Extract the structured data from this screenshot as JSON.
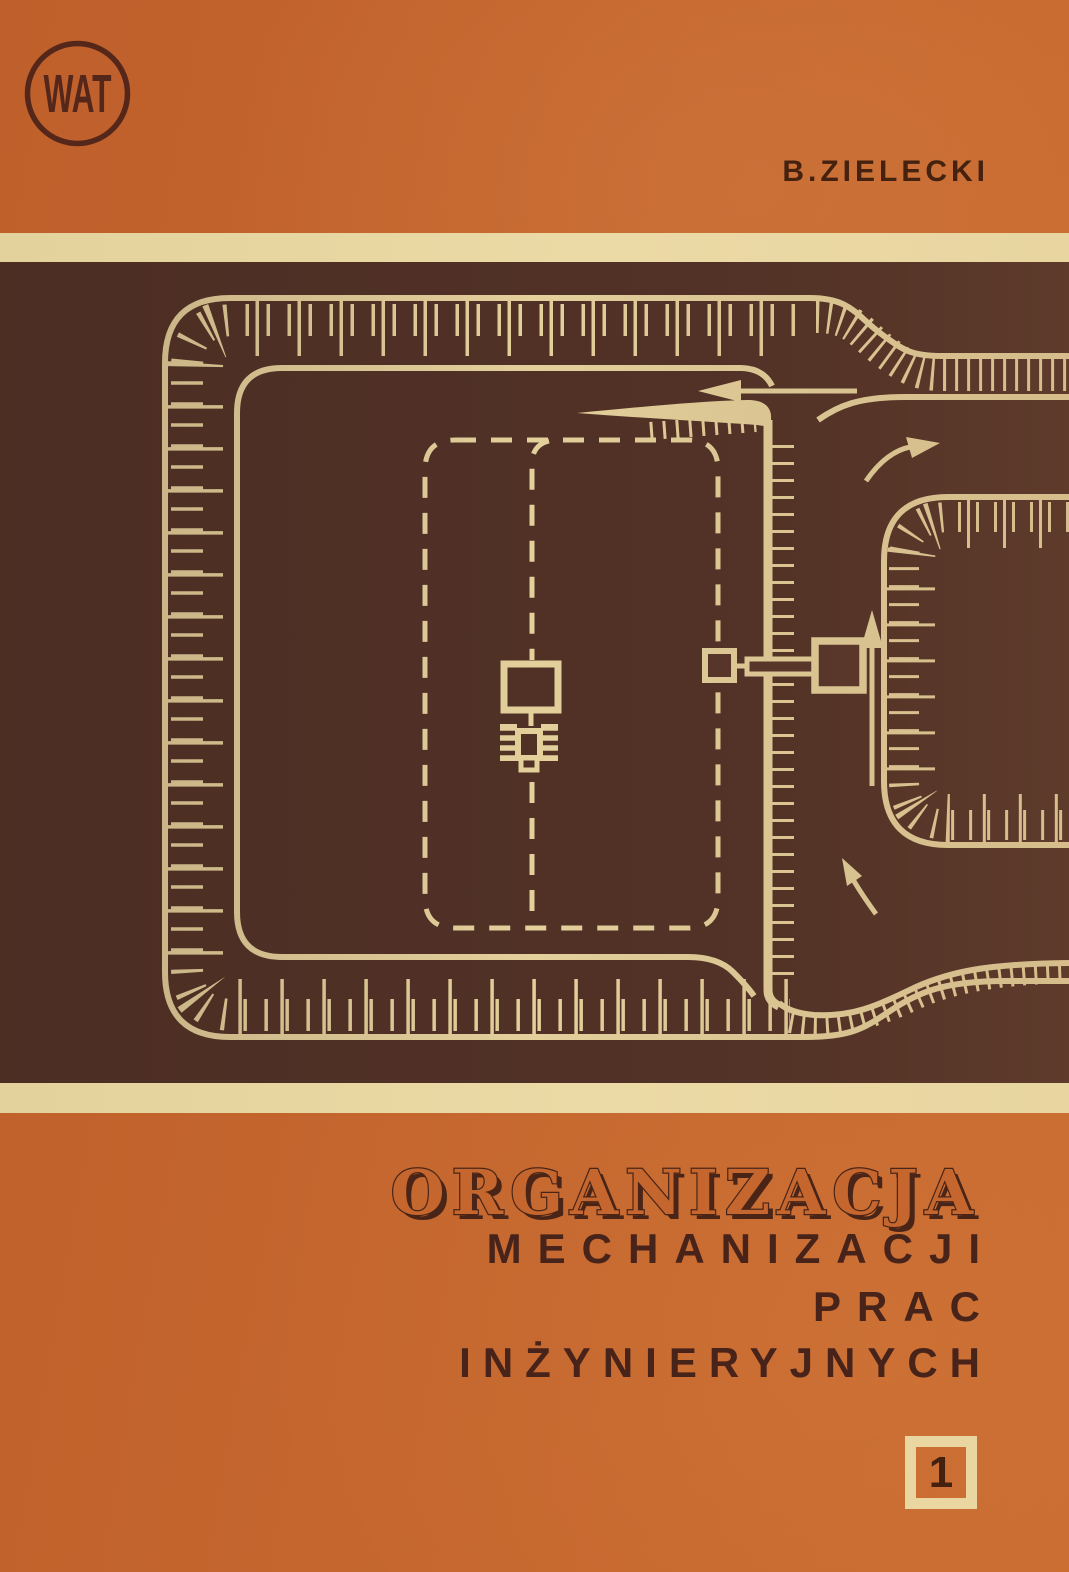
{
  "cover": {
    "publisher_logo_text": "WAT",
    "author": "B.ZIELECKI",
    "title_line1": "ORGANIZACJA",
    "title_line2": "MECHANIZACJI",
    "title_line3": "PRAC",
    "title_line4": "INŻYNIERYJNYCH",
    "volume_number": "1"
  },
  "colors": {
    "orange_background": "#c4662e",
    "cream_strip": "#e8d5a0",
    "diagram_line_cream": "#ecd9a2",
    "band_brown": "#523227",
    "dark_text_brown": "#45210f"
  }
}
